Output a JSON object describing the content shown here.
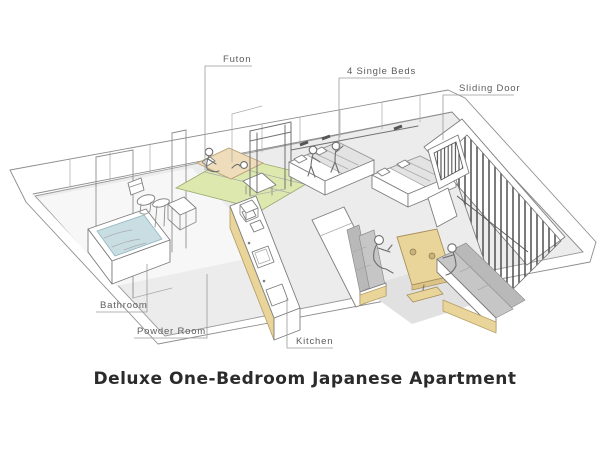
{
  "title": "Deluxe One-Bedroom Japanese Apartment",
  "labels": {
    "futon": "Futon",
    "single_beds": "4 Single Beds",
    "sliding_door": "Sliding Door",
    "bathroom": "Bathroom",
    "powder_room": "Powder Room",
    "kitchen": "Kitchen"
  },
  "colors": {
    "floor": "#ececec",
    "bath_floor": "#f7f7f7",
    "tatami": "#dce8ae",
    "futon_bedding": "#eedcba",
    "wood": "#e9d49a",
    "wood_dark": "#dcc488",
    "water": "#c9dee3",
    "cushion": "#c6c6c6",
    "cushion_dark": "#b9b9b9",
    "blanket": "#e3e3e3",
    "slats": "#4f4f4f",
    "shadow": "#e1e1e1",
    "label_text": "#5c5c5c",
    "title_text": "#2b2b2b"
  }
}
